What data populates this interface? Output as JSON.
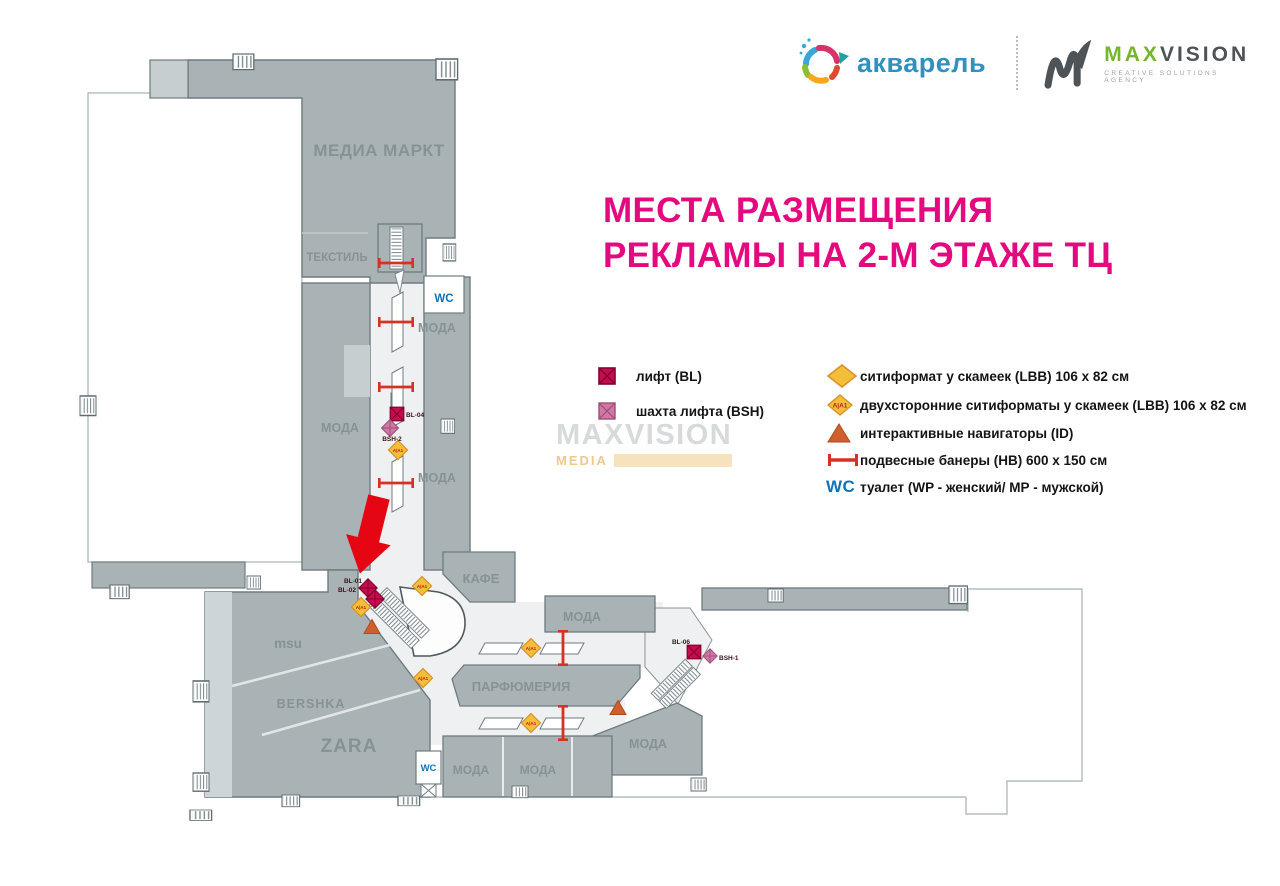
{
  "header": {
    "aquarelle": "акварель",
    "maxvision_max": "MAX",
    "maxvision_vision": "VISION",
    "maxvision_subtitle": "Creative Solutions Agency"
  },
  "title": {
    "line1": "МЕСТА РАЗМЕЩЕНИЯ",
    "line2": "РЕКЛАМЫ НА 2-М ЭТАЖЕ ТЦ"
  },
  "legend": {
    "left": [
      {
        "symbol": "lift-square",
        "label": "лифт (BL)"
      },
      {
        "symbol": "lift-shaft-square",
        "label": "шахта лифта (BSH)"
      }
    ],
    "right": [
      {
        "symbol": "cityformat-diamond",
        "label": "ситиформат у скамеек (LBB)  106 x 82 см"
      },
      {
        "symbol": "cityformat-double-diamond",
        "label": "двухсторонние ситиформаты у скамеек (LBB) 106 x 82 см"
      },
      {
        "symbol": "navigator-triangle",
        "label": "интерактивные навигаторы (ID)"
      },
      {
        "symbol": "hanging-banner",
        "label": "подвесные банеры (НВ)  600 x 150 см"
      },
      {
        "symbol": "wc",
        "label": "туалет (WP - женский/ МР - мужской)"
      }
    ],
    "wc_glyph": "WC",
    "aa_glyph": "A|A1"
  },
  "watermark": {
    "line1": "MAXVISION",
    "line2": "MEDIA"
  },
  "map": {
    "labels": {
      "media_markt": "МЕДИА МАРКТ",
      "textile": "ТЕКСТИЛЬ",
      "moda": "МОДА",
      "cafe": "КАФЕ",
      "parfum": "ПАРФЮМЕРИЯ",
      "msu": "msu",
      "bershka": "BERSHKA",
      "zara": "ZARA",
      "wc": "WC"
    },
    "markers": {
      "bl01": "BL-01",
      "bl02": "BL-02",
      "bl04": "BL-04",
      "bsh2": "BSH-2",
      "bl06": "BL-06",
      "bsh1": "BSH-1",
      "aa": "A|A1"
    },
    "colors": {
      "title": "#e5097f",
      "block_gray": "#a9b3b5",
      "corridor": "#eef0f1",
      "lift": "#c60b4e",
      "shaft": "#d077a3",
      "diamond": "#f3bf3b",
      "triangle": "#cf5f2e",
      "banner": "#d93025",
      "wc_blue": "#1173b5",
      "arrow": "#e60613"
    }
  }
}
